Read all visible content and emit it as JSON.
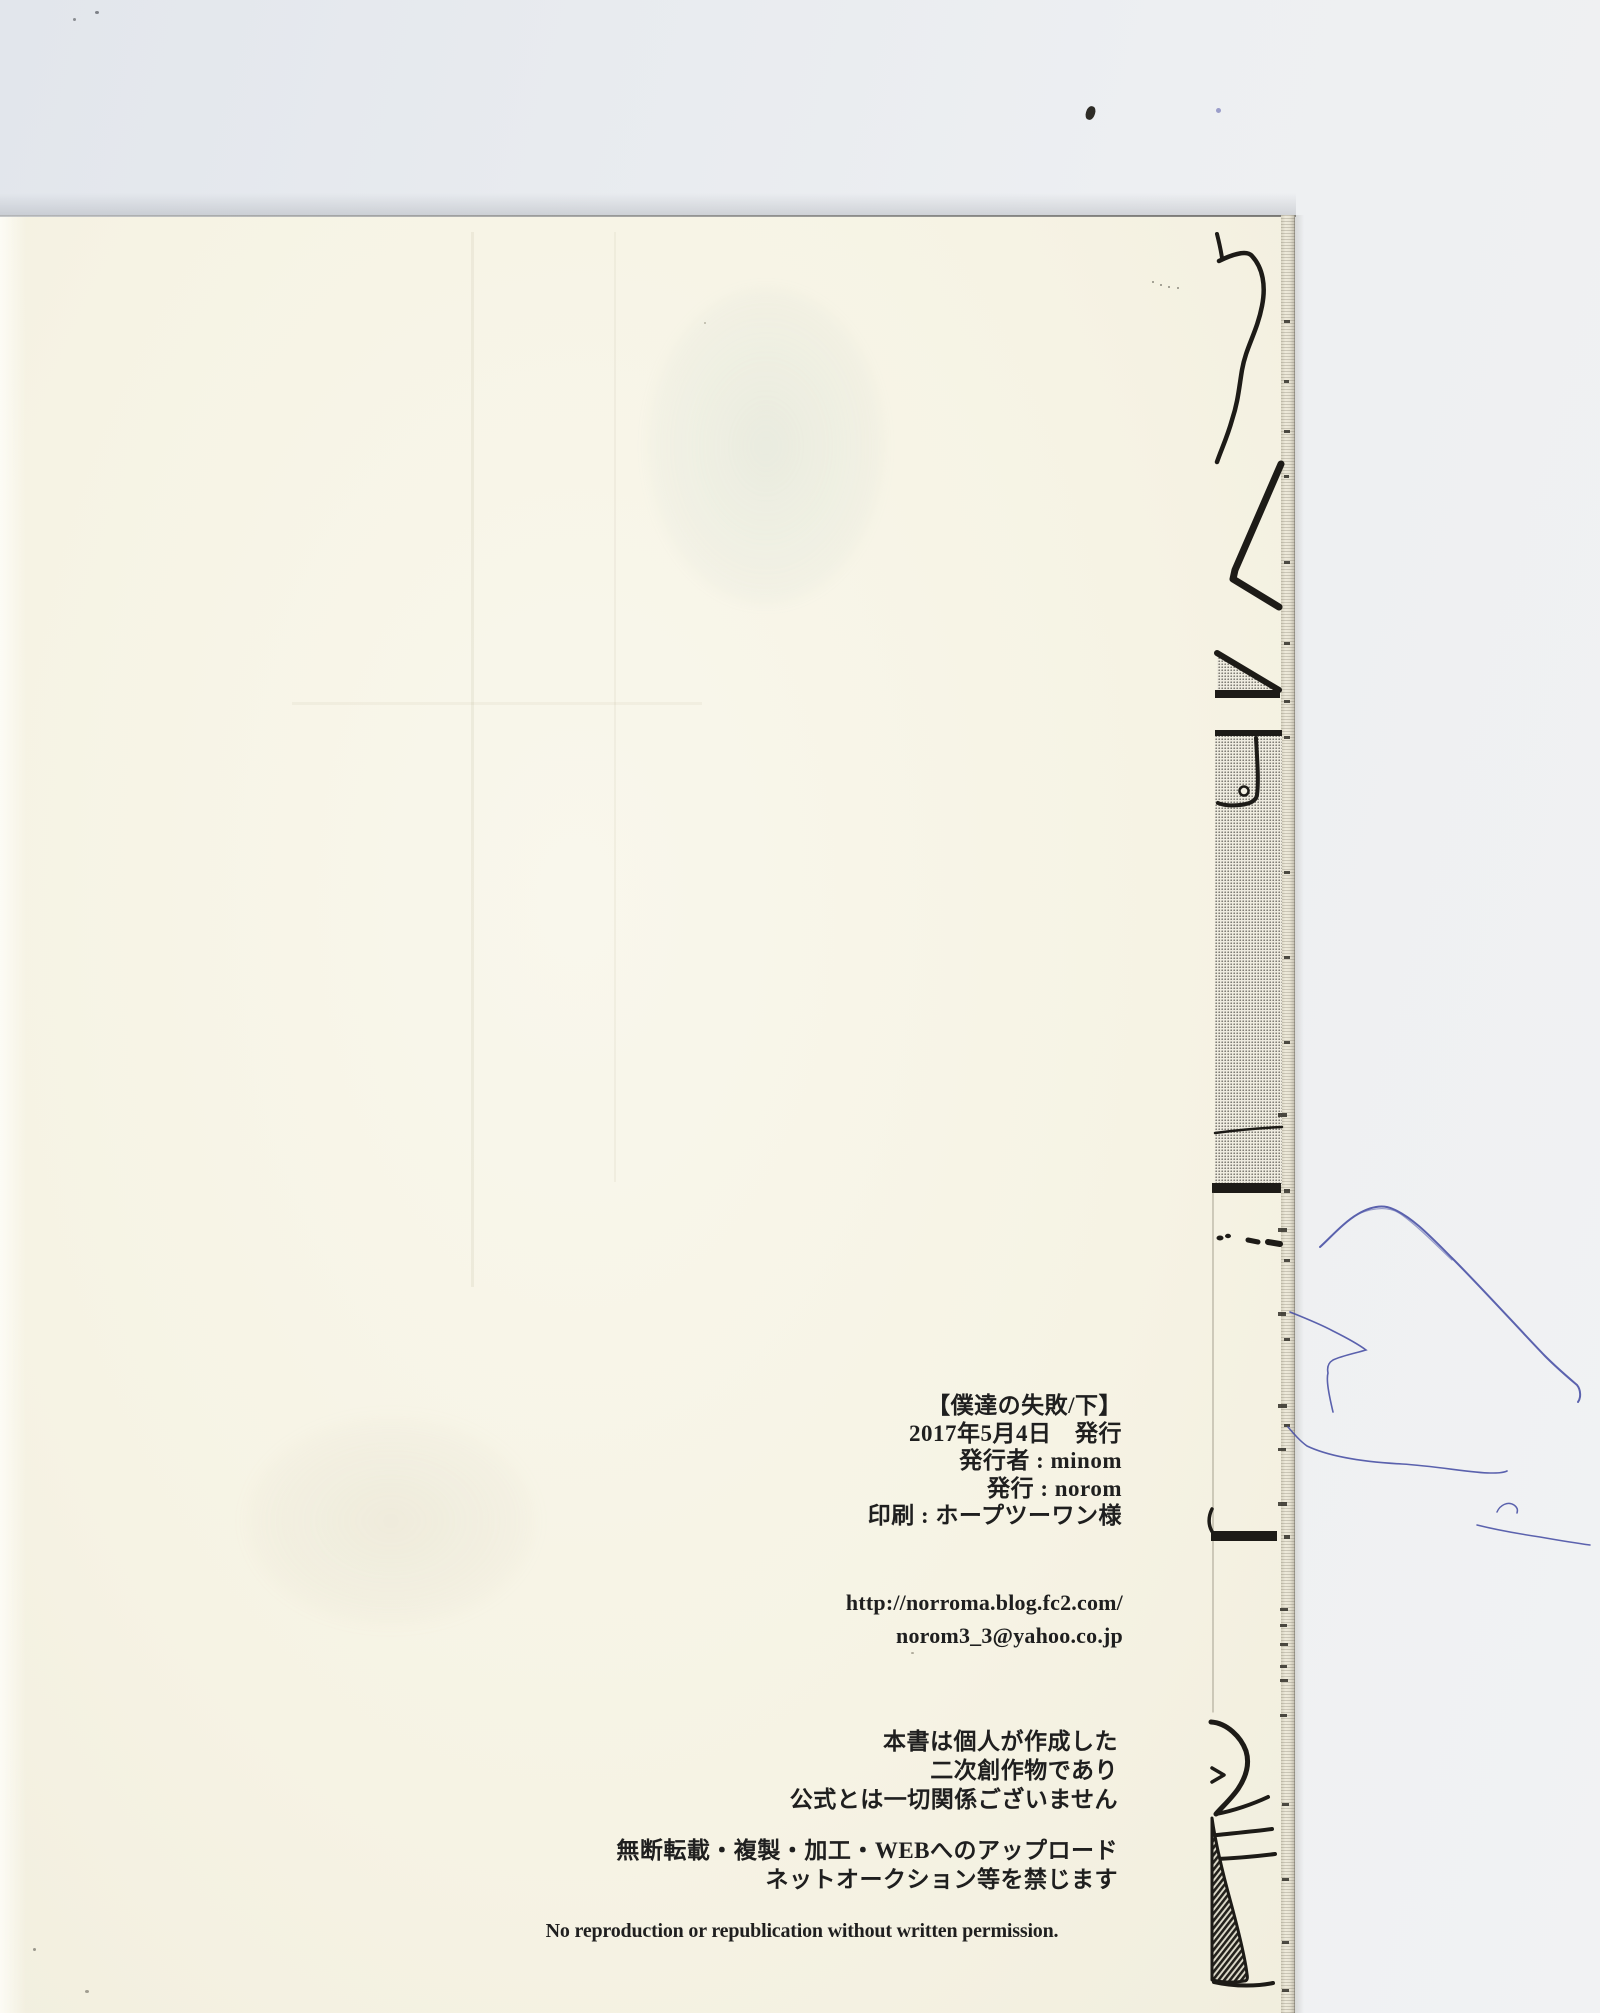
{
  "colophon": {
    "title": "【僕達の失敗/下】",
    "date_line": "2017年5月4日　発行",
    "publisher_line": "発行者 : minom",
    "issuer_line": "発行 : norom",
    "printer_line": "印刷 : ホープツーワン様",
    "url": "http://norroma.blog.fc2.com/",
    "email": "norom3_3@yahoo.co.jp",
    "disclaimer_lines": [
      "本書は個人が作成した",
      "二次創作物であり",
      "公式とは一切関係ございません"
    ],
    "prohibition_lines": [
      "無断転載・複製・加工・WEBへのアップロード",
      "ネットオークション等を禁じます"
    ],
    "english_notice": "No reproduction or republication without written permission."
  },
  "colors": {
    "page_cream": "#f7f4e6",
    "scanner_background": "#e9ecf0",
    "ink_black": "#1f1f1f",
    "screentone_gray": "#74716a",
    "pen_blue": "#4a52a6"
  }
}
